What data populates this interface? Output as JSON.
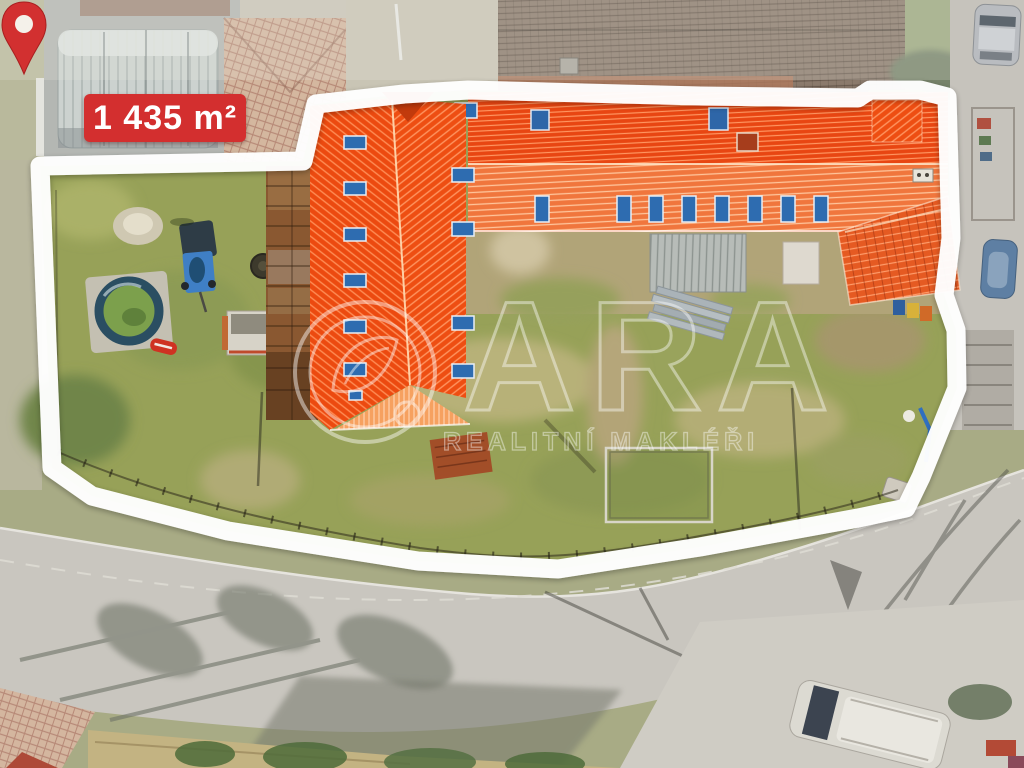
{
  "overlay": {
    "area_label": "1 435 m²",
    "watermark": {
      "brand": "ARA",
      "subtitle": "REALITNÍ MAKLÉŘI"
    }
  },
  "palette": {
    "label_red": "#d32f2f",
    "pin_red": "#d23030",
    "roof_orange_dark": "#ec4a10",
    "roof_orange_light": "#f0763d",
    "skylight_blue": "#2e6cb0",
    "grass_green": "#97a158",
    "boundary_white": "#ffffff"
  }
}
